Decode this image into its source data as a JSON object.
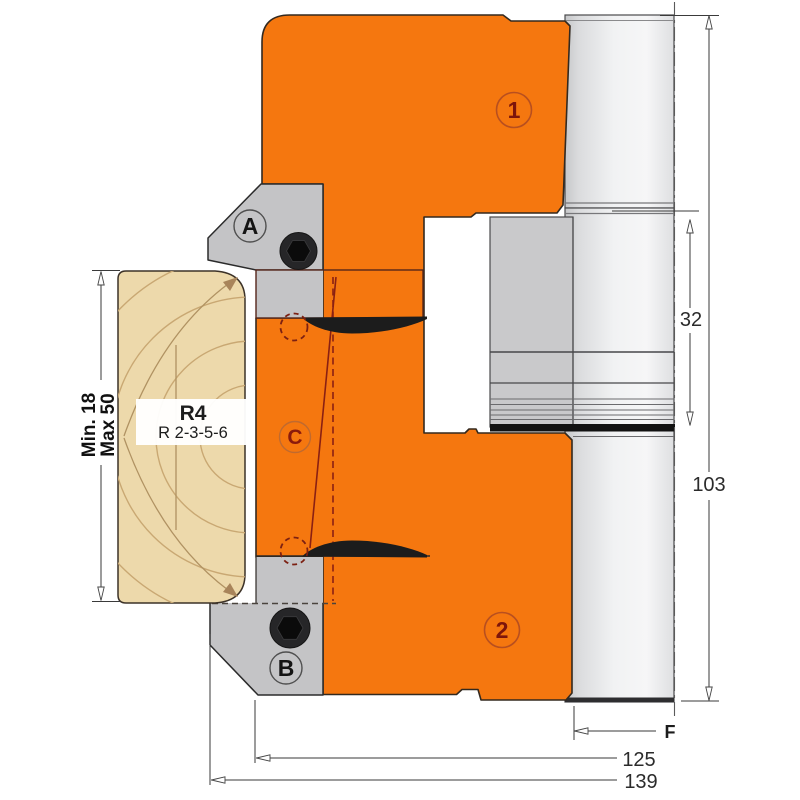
{
  "diagram": {
    "description": "Cross-section technical drawing of a profile cutter head with interchangeable knives cutting a rounded-edge wood profile",
    "callouts": {
      "a": "A",
      "b": "B",
      "c": "C",
      "pos1": "1",
      "pos2": "2"
    },
    "wood": {
      "radius_label": "R4",
      "radius_options": "R 2-3-5-6",
      "min": "Min. 18",
      "max": "Max 50"
    },
    "dimensions": {
      "hub_step": "32",
      "total_height": "103",
      "bore": "F",
      "body_dia": "125",
      "cutting_dia": "139"
    },
    "colors": {
      "body_orange": "#f5770f",
      "steel_gray": "#c4c4c6",
      "bore_gray": "#c9c9cb",
      "wood_tan": "#edd9ab",
      "wood_grain": "#c9a873",
      "accent_red": "#8a2013",
      "knife_black": "#1c1c1c",
      "dim_gray": "#3a3a3a"
    }
  }
}
